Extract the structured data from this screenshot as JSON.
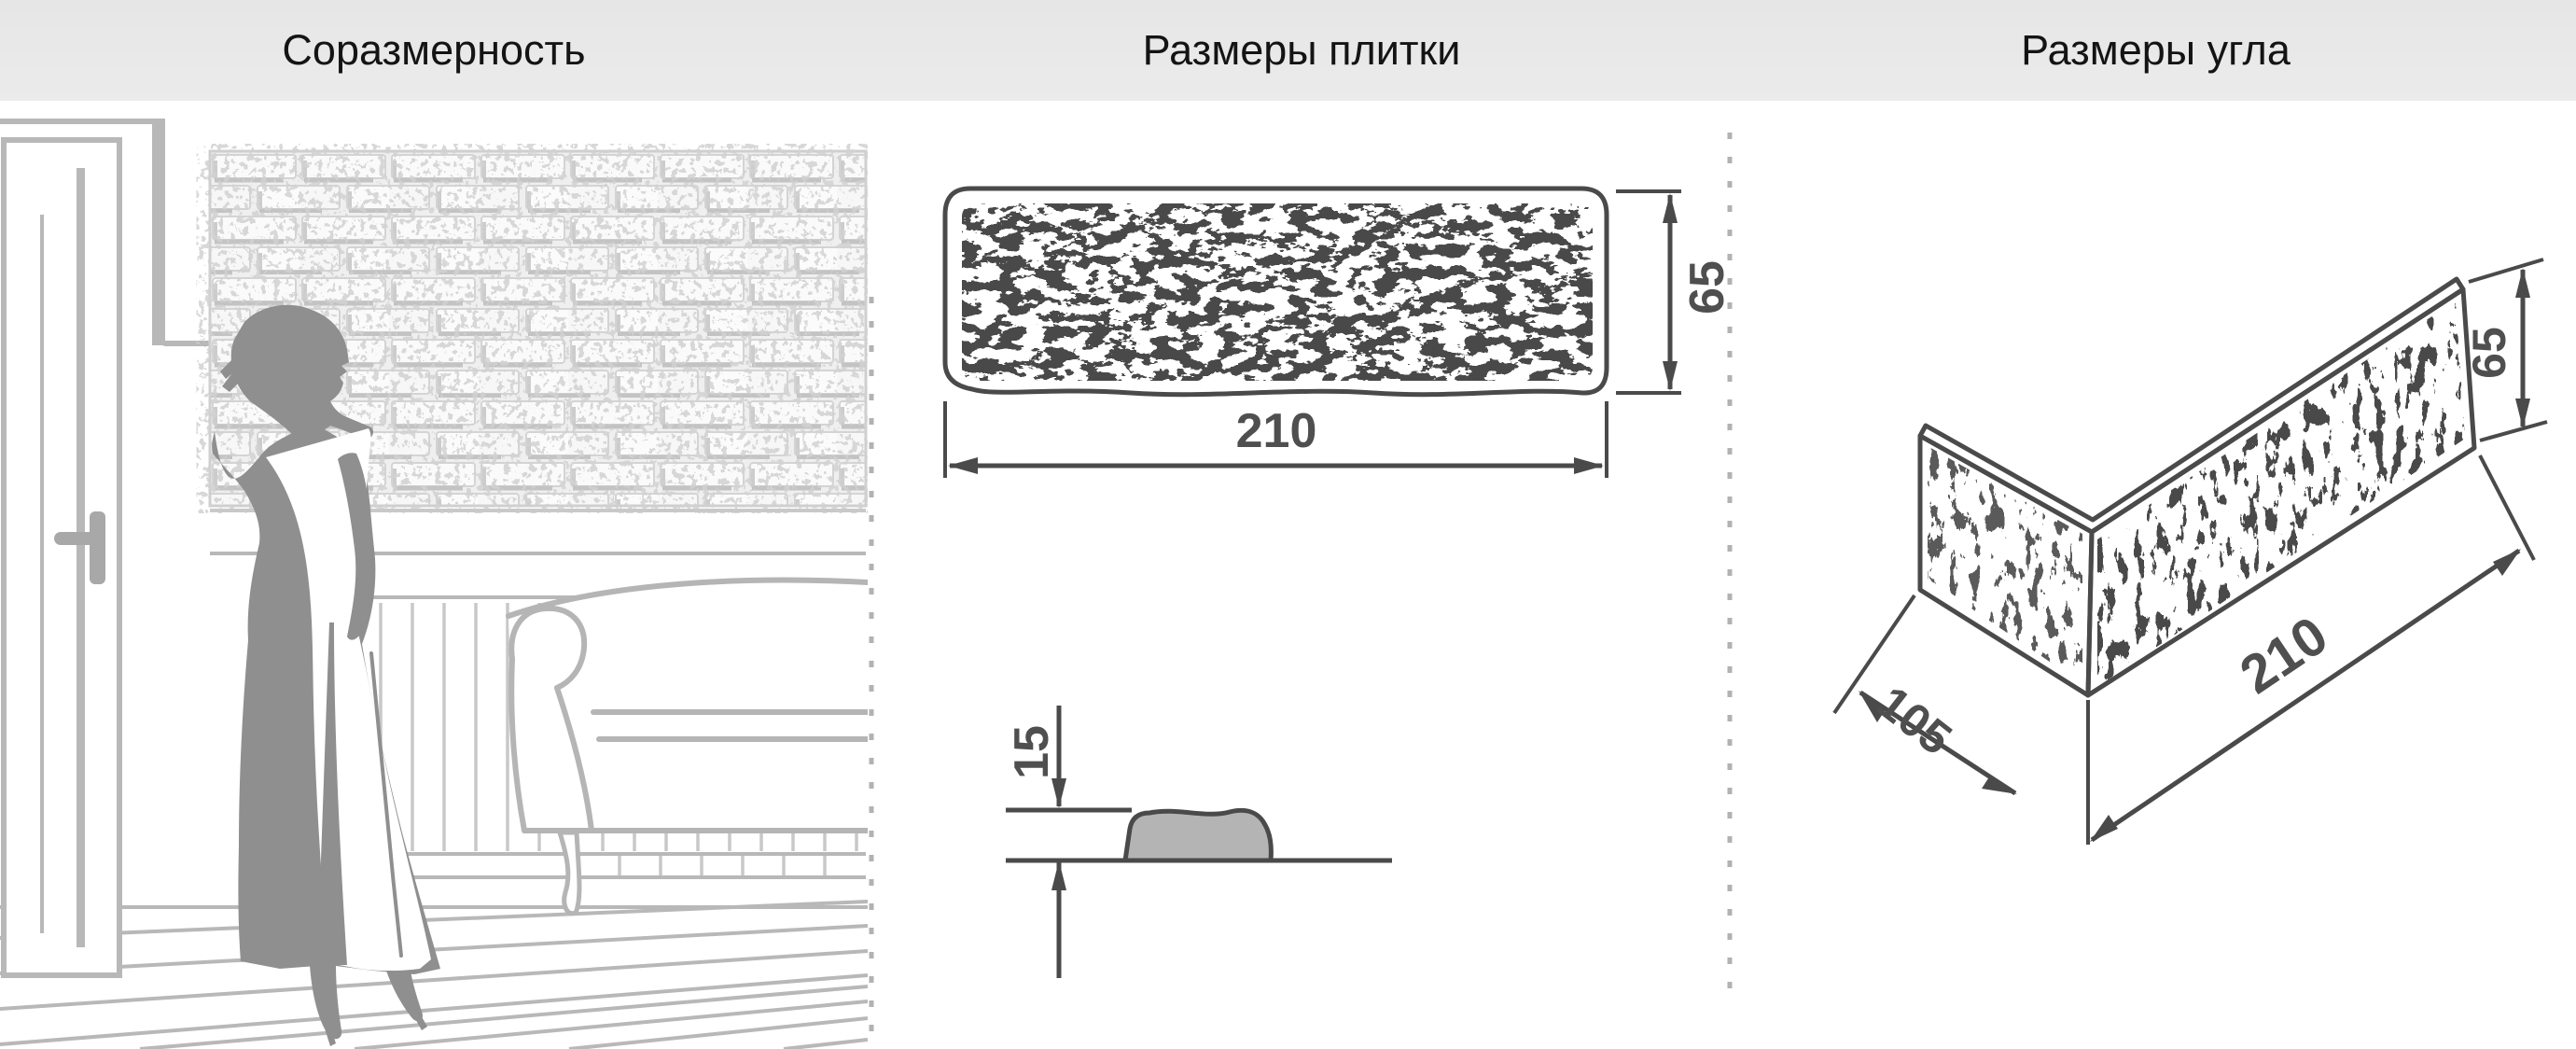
{
  "header": {
    "background": "#e8e8e8",
    "text_color": "#141414",
    "titles": {
      "proportionality": "Соразмерность",
      "tile_dimensions": "Размеры плитки",
      "corner_dimensions": "Размеры угла"
    }
  },
  "panels": {
    "proportionality": {
      "elements": [
        "door",
        "door-handle",
        "brick-wall",
        "woman-silhouette",
        "radiator-panel",
        "sofa",
        "plank-floor"
      ]
    },
    "tile": {
      "front_view": {
        "width_mm": "210",
        "height_mm": "65"
      },
      "profile_view": {
        "thickness_mm": "15"
      }
    },
    "corner": {
      "depth_mm": "105",
      "width_mm": "210",
      "height_mm": "65"
    }
  },
  "style": {
    "drawing_line_color": "#4a4a4a",
    "dimension_text_color": "#4f4f4f",
    "scene_line_color": "#b8b8b8",
    "silhouette_color": "#8f8f8f",
    "profile_fill_color": "#b4b4b4",
    "divider_color": "#b2b2b2",
    "brick_shadow_color": "#c3c3c3"
  }
}
